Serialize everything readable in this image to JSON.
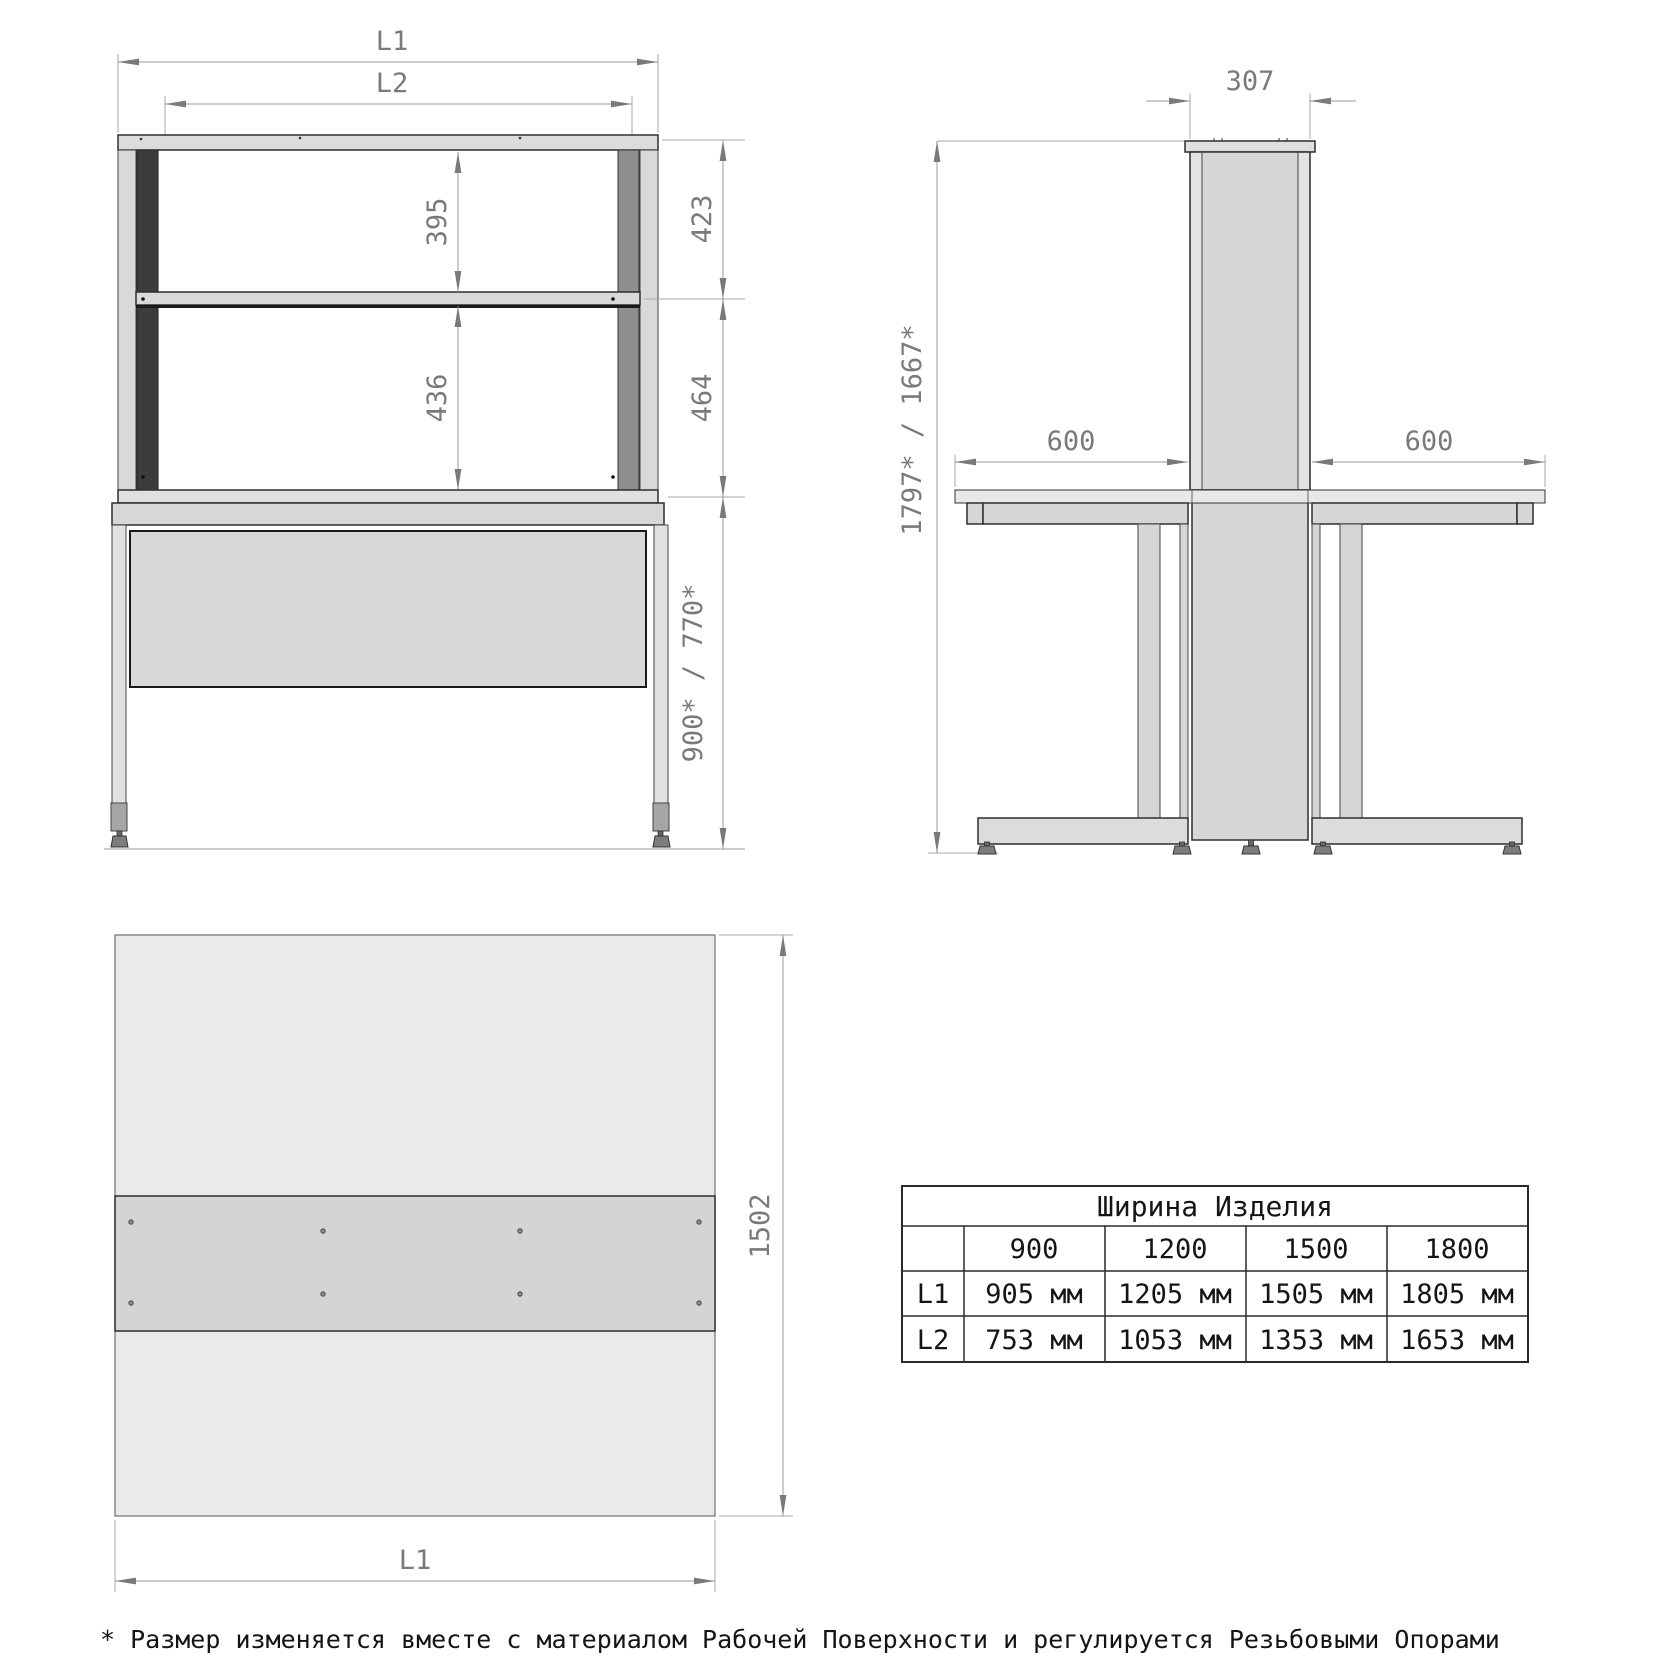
{
  "front_view": {
    "dim_l1": "L1",
    "dim_l2": "L2",
    "dim_shelf_upper": "395",
    "dim_shelf_lower": "436",
    "dim_right_top": "423",
    "dim_right_mid": "464",
    "dim_table_height": "900* / 770*"
  },
  "side_view": {
    "dim_column_depth": "307",
    "dim_left_span": "600",
    "dim_right_span": "600",
    "dim_total_height": "1797* / 1667*"
  },
  "top_view": {
    "dim_depth": "1502",
    "dim_width": "L1"
  },
  "size_table": {
    "title": "Ширина Изделия",
    "col_headers": [
      "900",
      "1200",
      "1500",
      "1800"
    ],
    "rows": [
      {
        "label": "L1",
        "values": [
          "905 мм",
          "1205 мм",
          "1505 мм",
          "1805 мм"
        ]
      },
      {
        "label": "L2",
        "values": [
          "753 мм",
          "1053 мм",
          "1353 мм",
          "1653 мм"
        ]
      }
    ]
  },
  "footnote": "* Размер изменяется вместе с материалом Рабочей Поверхности и регулируется Резьбовыми Опорами",
  "colors": {
    "dimension_gray": "#7a7a7a",
    "outline_dark": "#2e2e2e",
    "fill_light": "#eaeaea",
    "fill_mid": "#d6d6d6",
    "dark_post": "#3c3c3c",
    "text_black": "#141414"
  }
}
